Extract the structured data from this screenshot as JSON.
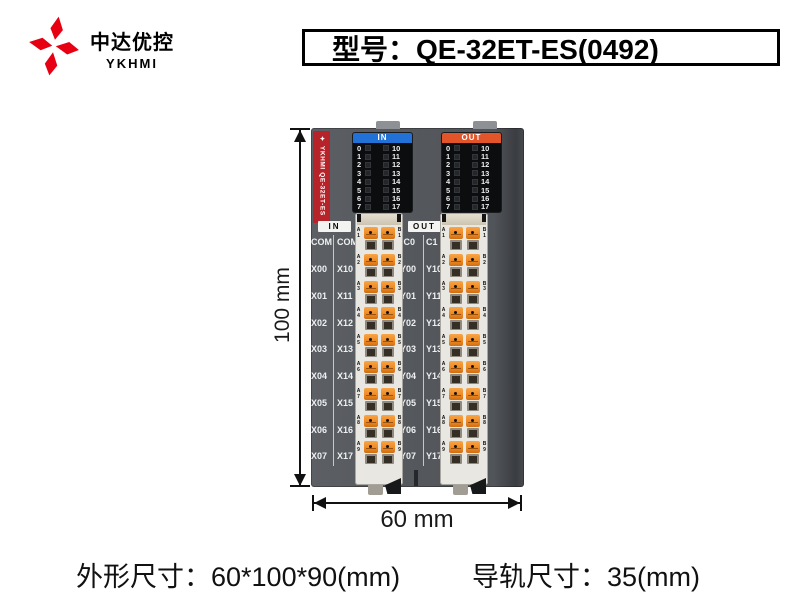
{
  "brand": {
    "name_cn": "中达优控",
    "name_en": "YKHMI"
  },
  "title": "型号：QE-32ET-ES(0492)",
  "module": {
    "side_label": "✦ YKHMI  QE-32ET-ES",
    "panels": [
      {
        "title": "IN",
        "color": "#2271d6",
        "left": [
          "0",
          "1",
          "2",
          "3",
          "4",
          "5",
          "6",
          "7"
        ],
        "right": [
          "10",
          "11",
          "12",
          "13",
          "14",
          "15",
          "16",
          "17"
        ]
      },
      {
        "title": "OUT",
        "color": "#e2552a",
        "left": [
          "0",
          "1",
          "2",
          "3",
          "4",
          "5",
          "6",
          "7"
        ],
        "right": [
          "10",
          "11",
          "12",
          "13",
          "14",
          "15",
          "16",
          "17"
        ]
      }
    ],
    "io": [
      {
        "title": "IN",
        "rows": [
          [
            "COM",
            "COM"
          ],
          [
            "X00",
            "X10"
          ],
          [
            "X01",
            "X11"
          ],
          [
            "X02",
            "X12"
          ],
          [
            "X03",
            "X13"
          ],
          [
            "X04",
            "X14"
          ],
          [
            "X05",
            "X15"
          ],
          [
            "X06",
            "X16"
          ],
          [
            "X07",
            "X17"
          ]
        ]
      },
      {
        "title": "OUT",
        "rows": [
          [
            "C0",
            "C1"
          ],
          [
            "Y00",
            "Y10"
          ],
          [
            "Y01",
            "Y11"
          ],
          [
            "Y02",
            "Y12"
          ],
          [
            "Y03",
            "Y13"
          ],
          [
            "Y04",
            "Y14"
          ],
          [
            "Y05",
            "Y15"
          ],
          [
            "Y06",
            "Y16"
          ],
          [
            "Y07",
            "Y17"
          ]
        ]
      }
    ],
    "clamps": {
      "left_letter": "A",
      "right_letter": "B",
      "numbers": [
        "1",
        "2",
        "3",
        "4",
        "5",
        "6",
        "7",
        "8",
        "9"
      ]
    }
  },
  "dimensions": {
    "height": "100 mm",
    "width": "60 mm"
  },
  "footer": {
    "size": "外形尺寸：60*100*90(mm)",
    "rail": "导轨尺寸：35(mm)"
  },
  "colors": {
    "accent_red": "#e60012",
    "side_strip": "#b6242a"
  }
}
